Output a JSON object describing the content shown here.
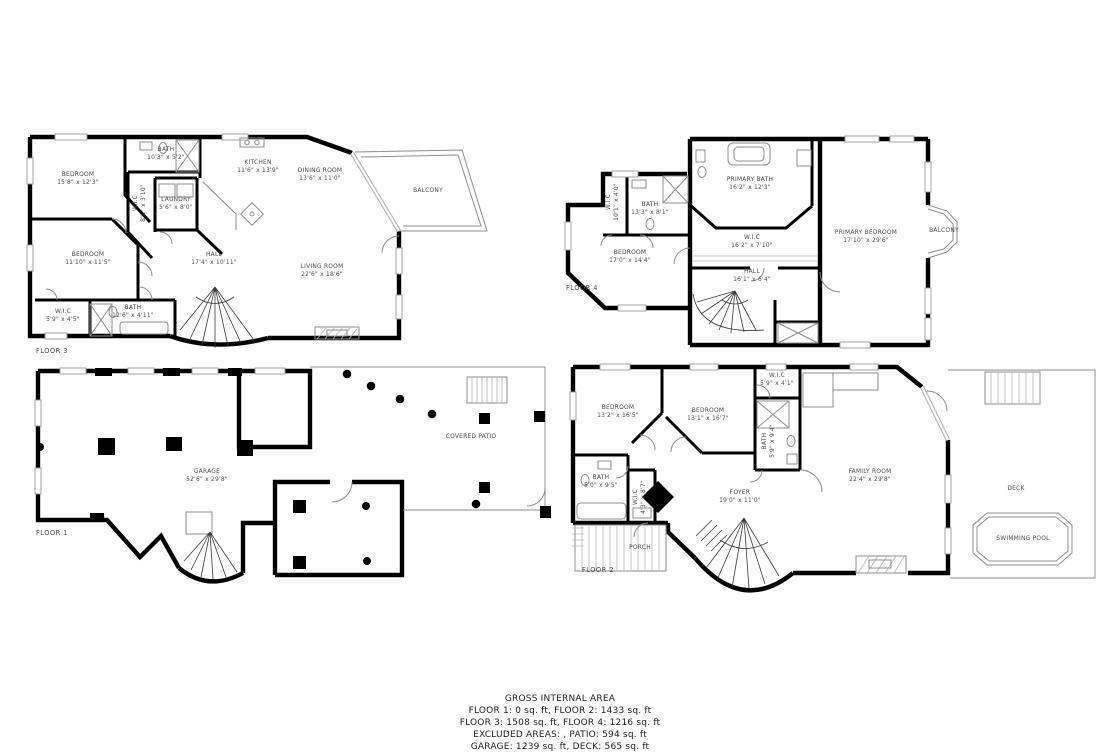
{
  "colors": {
    "wall": "#000000",
    "thin_line": "#8d8d8d",
    "label_text": "#4a4a4a",
    "background": "#ffffff"
  },
  "floors": {
    "floor3": {
      "label": "FLOOR 3",
      "rooms": [
        {
          "name": "BEDROOM",
          "dims": "15'8\" x 12'3\""
        },
        {
          "name": "BATH",
          "dims": "10'3\" x 5'2\""
        },
        {
          "name": "KITCHEN",
          "dims": "11'6\" x 13'9\""
        },
        {
          "name": "LAUNDRY",
          "dims": "5'6\" x 8'0\""
        },
        {
          "name": "W.I.C",
          "dims": "8'1\" x 3'10\""
        },
        {
          "name": "DINING ROOM",
          "dims": "13'6\" x 11'0\""
        },
        {
          "name": "BALCONY",
          "dims": ""
        },
        {
          "name": "LIVING ROOM",
          "dims": "22'6\" x 18'6\""
        },
        {
          "name": "BEDROOM",
          "dims": "11'10\" x 11'5\""
        },
        {
          "name": "HALL",
          "dims": "17'4\" x 10'11\""
        },
        {
          "name": "W.I.C",
          "dims": "5'9\" x 4'5\""
        },
        {
          "name": "BATH",
          "dims": "12'6\" x 4'11\""
        }
      ]
    },
    "floor4": {
      "label": "FLOOR 4",
      "rooms": [
        {
          "name": "PRIMARY BATH",
          "dims": "16'2\" x 12'3\""
        },
        {
          "name": "W.I.C",
          "dims": "16'2\" x 7'10\""
        },
        {
          "name": "HALL",
          "dims": "16'1\" x 6'4\""
        },
        {
          "name": "BEDROOM",
          "dims": "17'0\" x 14'4\""
        },
        {
          "name": "BATH",
          "dims": "13'3\" x 8'1\""
        },
        {
          "name": "W.I.C",
          "dims": "10'1\" x 4'0\""
        },
        {
          "name": "PRIMARY BEDROOM",
          "dims": "17'10\" x 29'6\""
        },
        {
          "name": "BALCONY",
          "dims": ""
        }
      ]
    },
    "floor1": {
      "label": "FLOOR 1",
      "rooms": [
        {
          "name": "GARAGE",
          "dims": "52'6\" x 29'8\""
        },
        {
          "name": "COVERED PATIO",
          "dims": ""
        }
      ]
    },
    "floor2": {
      "label": "FLOOR 2",
      "rooms": [
        {
          "name": "BEDROOM",
          "dims": "13'2\" x 16'5\""
        },
        {
          "name": "BEDROOM",
          "dims": "13'1\" x 16'7\""
        },
        {
          "name": "W.I.C",
          "dims": "5'9\" x 4'1\""
        },
        {
          "name": "BATH",
          "dims": "5'9\" x 9'4\""
        },
        {
          "name": "BATH",
          "dims": "5'0\" x 9'5\""
        },
        {
          "name": "W.I.C",
          "dims": "4'3\" x 8'7\""
        },
        {
          "name": "FOYER",
          "dims": "19'0\" x 11'0\""
        },
        {
          "name": "PORCH",
          "dims": ""
        },
        {
          "name": "FAMILY ROOM",
          "dims": "22'4\" x 29'8\""
        },
        {
          "name": "DECK",
          "dims": ""
        },
        {
          "name": "SWIMMING POOL",
          "dims": ""
        }
      ]
    }
  },
  "summary": {
    "title": "GROSS INTERNAL AREA",
    "lines": [
      "FLOOR 1: 0 sq. ft, FLOOR 2: 1433 sq. ft",
      "FLOOR 3: 1508 sq. ft, FLOOR 4: 1216 sq. ft",
      "EXCLUDED AREAS: , PATIO: 594 sq. ft",
      "GARAGE: 1239 sq. ft, DECK: 565 sq. ft"
    ]
  }
}
